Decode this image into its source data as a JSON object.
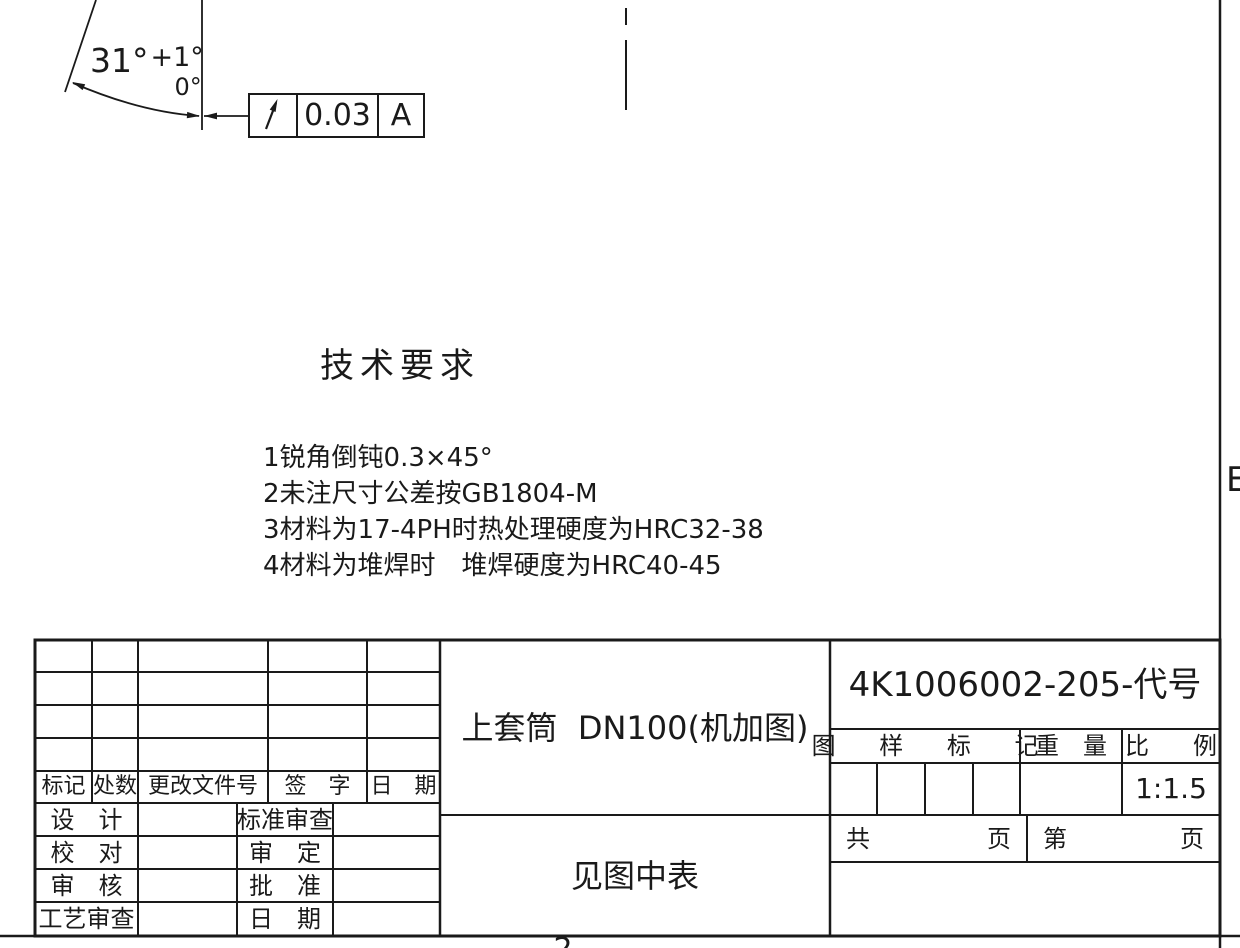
{
  "drawing": {
    "angle_dim": {
      "value": "31°",
      "tol_upper": "+1°",
      "tol_lower": "0°"
    },
    "fcf": {
      "symbol": "circular-runout",
      "tolerance": "0.03",
      "datum": "A"
    },
    "zone_letter_right": "E",
    "zone_number_bottom": "2"
  },
  "tech_req": {
    "heading": "技术要求",
    "items": [
      "1锐角倒钝0.3×45°",
      "2未注尺寸公差按GB1804-M",
      "3材料为17-4PH时热处理硬度为HRC32-38",
      "4材料为堆焊时　堆焊硬度为HRC40-45"
    ]
  },
  "title_block": {
    "revision_header": [
      "标记",
      "处数",
      "更改文件号",
      "签　字",
      "日　期"
    ],
    "approval_rows": [
      {
        "left_label": "设　计",
        "right_label": "标准审查"
      },
      {
        "left_label": "校　对",
        "right_label": "审　定"
      },
      {
        "left_label": "审　核",
        "right_label": "批　准"
      },
      {
        "left_label": "工艺审查",
        "right_label": "日　期"
      }
    ],
    "title": "上套筒  DN100(机加图)",
    "drawing_number": "4K1006002-205-代号",
    "stamp_header": {
      "mark": "图 样 标 记",
      "weight": "重　量",
      "scale": "比　例"
    },
    "scale_value": "1:1.5",
    "sheet_row": {
      "total_label": "共",
      "total_unit": "页",
      "page_label": "第",
      "page_unit": "页"
    },
    "material_note": "见图中表"
  }
}
